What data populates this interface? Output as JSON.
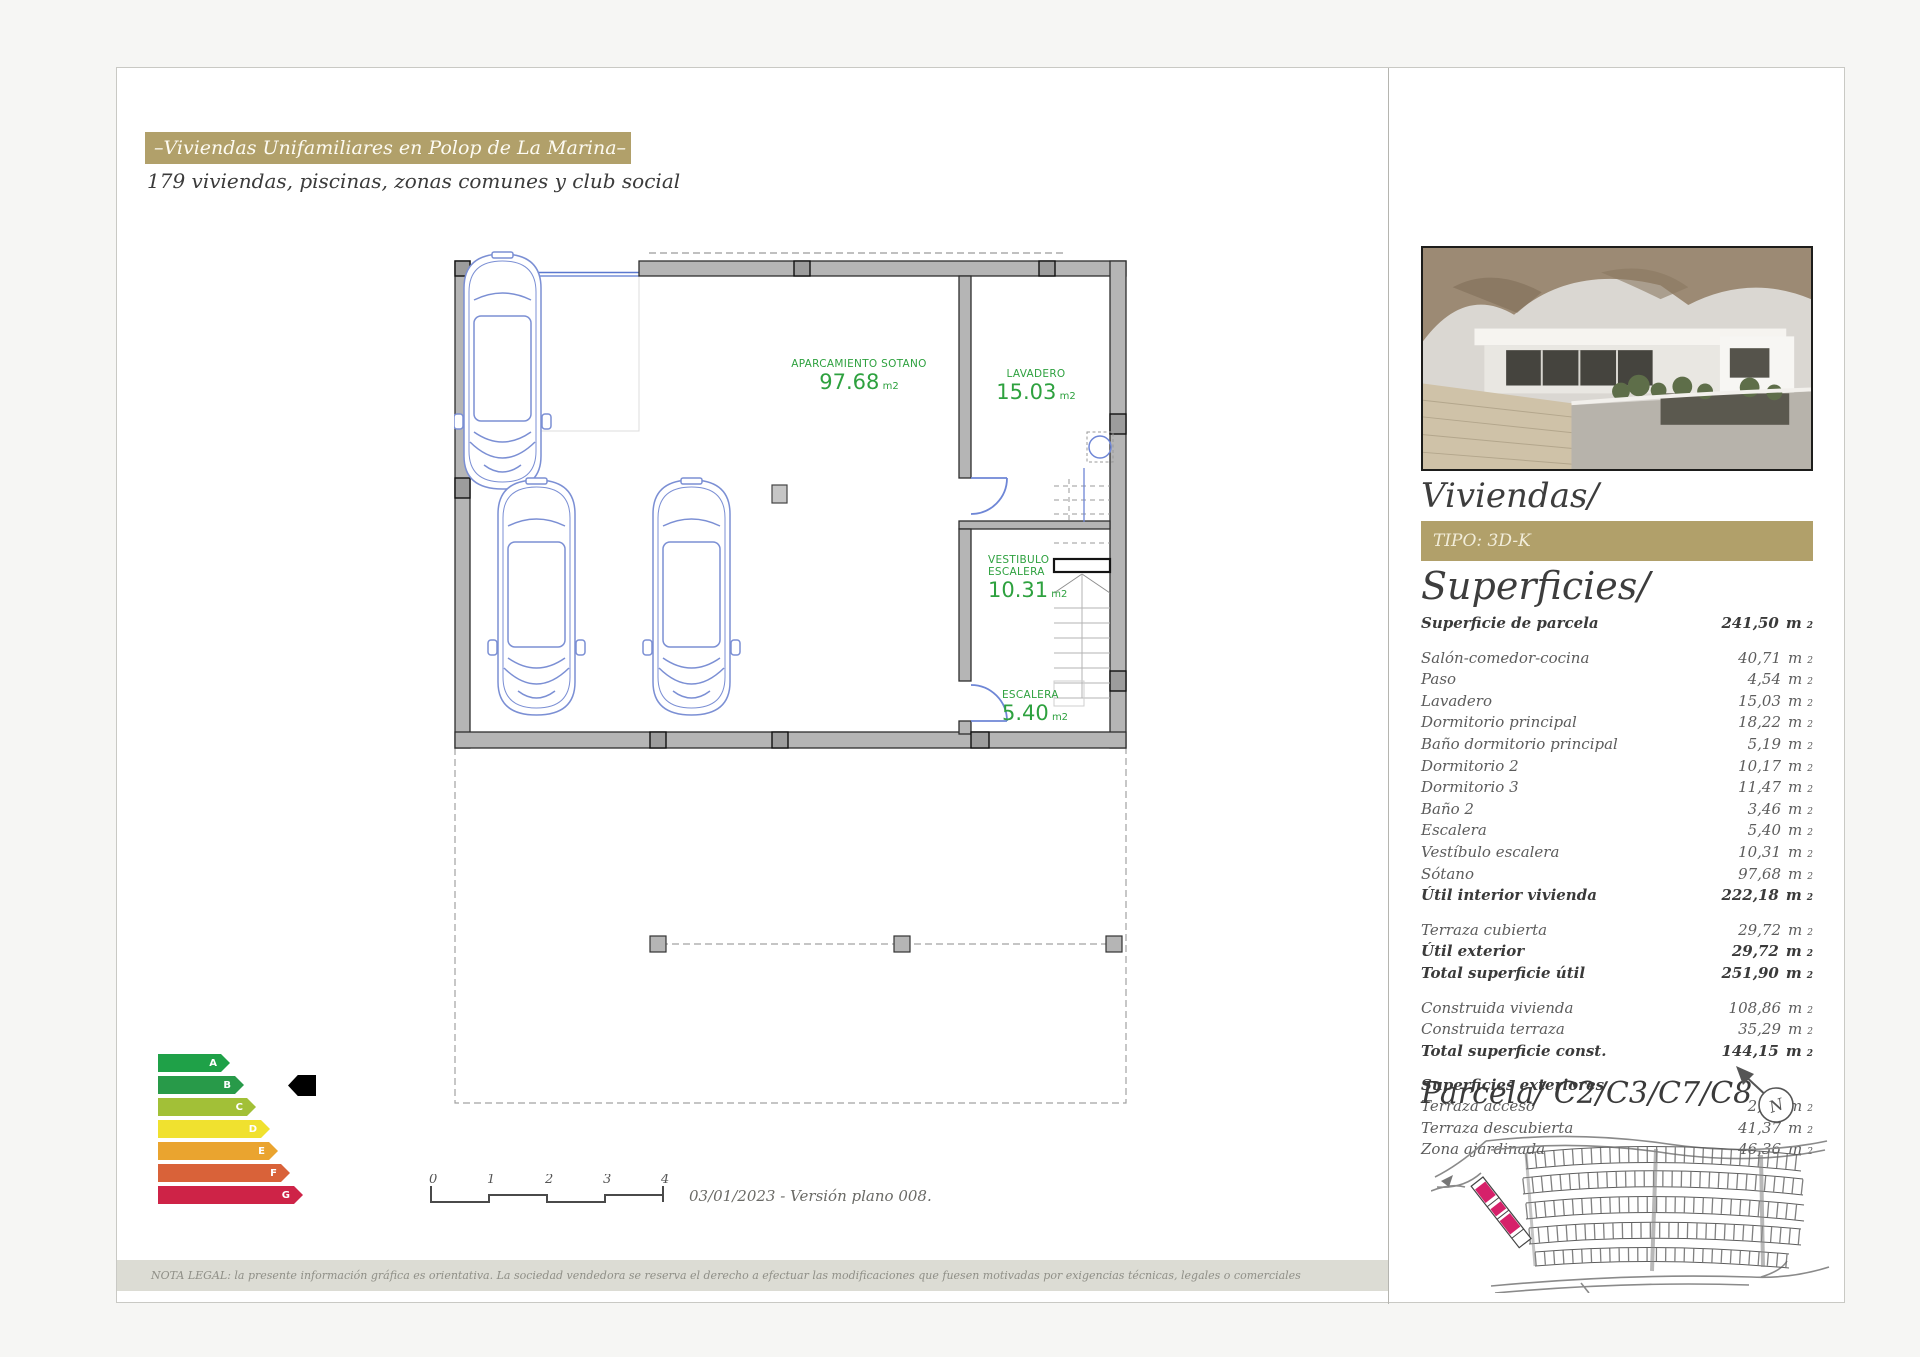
{
  "header": {
    "title": "–Viviendas Unifamiliares en Polop de La Marina–",
    "subtitle": "179 viviendas, piscinas, zonas comunes y club social"
  },
  "plan": {
    "rooms": [
      {
        "name": "APARCAMIENTO SOTANO",
        "value": "97.68",
        "unit": "m2"
      },
      {
        "name": "LAVADERO",
        "value": "15.03",
        "unit": "m2"
      },
      {
        "name": "VESTIBULO\nESCALERA",
        "value": "10.31",
        "unit": "m2"
      },
      {
        "name": "ESCALERA",
        "value": "5.40",
        "unit": "m2"
      }
    ]
  },
  "energy": {
    "selected": "B",
    "grades": [
      {
        "letter": "A",
        "color": "#1fa148",
        "width": 72
      },
      {
        "letter": "B",
        "color": "#289a49",
        "width": 86
      },
      {
        "letter": "C",
        "color": "#a2c037",
        "width": 98
      },
      {
        "letter": "D",
        "color": "#f0e12f",
        "width": 112
      },
      {
        "letter": "E",
        "color": "#eaa42f",
        "width": 120
      },
      {
        "letter": "F",
        "color": "#d96239",
        "width": 132
      },
      {
        "letter": "G",
        "color": "#ce2347",
        "width": 145
      }
    ]
  },
  "scalebar": {
    "ticks": [
      "0",
      "1",
      "2",
      "3",
      "4"
    ]
  },
  "footer": {
    "date_version": "03/01/2023 - Versión plano 008.",
    "legal": "NOTA LEGAL: la presente información gráfica es orientativa. La sociedad vendedora se reserva el derecho a efectuar las modificaciones que fuesen motivadas por exigencias técnicas, legales o comerciales"
  },
  "sidebar": {
    "title": "Viviendas/",
    "tipo": "TIPO: 3D-K",
    "superficies_title": "Superficies/",
    "unit": "m",
    "unit_sup": "2",
    "groups": [
      {
        "rows": [
          {
            "label": "Superficie de parcela",
            "value": "241,50",
            "bold": true
          }
        ]
      },
      {
        "rows": [
          {
            "label": "Salón-comedor-cocina",
            "value": "40,71"
          },
          {
            "label": "Paso",
            "value": "4,54"
          },
          {
            "label": "Lavadero",
            "value": "15,03"
          },
          {
            "label": "Dormitorio principal",
            "value": "18,22"
          },
          {
            "label": "Baño dormitorio principal",
            "value": "5,19"
          },
          {
            "label": "Dormitorio 2",
            "value": "10,17"
          },
          {
            "label": "Dormitorio 3",
            "value": "11,47"
          },
          {
            "label": "Baño 2",
            "value": "3,46"
          },
          {
            "label": "Escalera",
            "value": "5,40"
          },
          {
            "label": "Vestíbulo escalera",
            "value": "10,31"
          },
          {
            "label": "Sótano",
            "value": "97,68"
          },
          {
            "label": "Útil interior vivienda",
            "value": "222,18",
            "bold": true
          }
        ]
      },
      {
        "rows": [
          {
            "label": "Terraza cubierta",
            "value": "29,72"
          },
          {
            "label": "Útil exterior",
            "value": "29,72",
            "bold": true
          },
          {
            "label": "Total superficie útil",
            "value": "251,90",
            "bold": true
          }
        ]
      },
      {
        "rows": [
          {
            "label": "Construida vivienda",
            "value": "108,86"
          },
          {
            "label": "Construida terraza",
            "value": "35,29"
          },
          {
            "label": "Total superficie const.",
            "value": "144,15",
            "bold": true
          }
        ]
      },
      {
        "header": "Superficies exteriores",
        "rows": [
          {
            "label": "Terraza acceso",
            "value": "2,44"
          },
          {
            "label": "Terraza descubierta",
            "value": "41,37"
          },
          {
            "label": "Zona ajardinada",
            "value": "46,36"
          }
        ]
      }
    ],
    "parcela_label": "Parcela/",
    "parcela_codes": " C2/C3/C7/C8"
  },
  "colors": {
    "gold": "#b1a06a",
    "plan_green": "#2ea13f",
    "plan_blue": "#7b8fd4",
    "highlight_pink": "#d6216a",
    "wall_gray": "#b5b5b5"
  }
}
